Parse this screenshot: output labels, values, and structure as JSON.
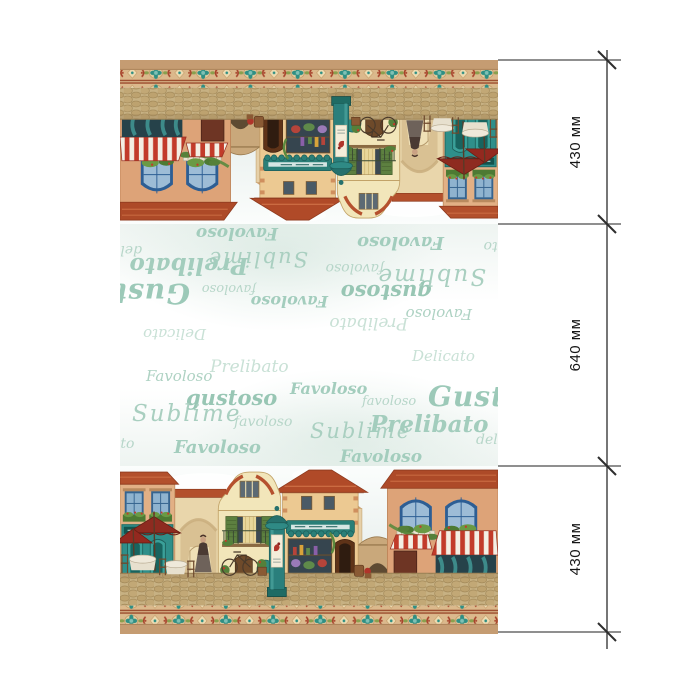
{
  "dimensions": {
    "segments": [
      {
        "label": "430 мм"
      },
      {
        "label": "640 мм"
      },
      {
        "label": "430 мм"
      }
    ]
  },
  "fabric": {
    "script_words": [
      {
        "text": "Favoloso"
      },
      {
        "text": "Prelibato"
      },
      {
        "text": "gustoso"
      },
      {
        "text": "Favoloso"
      },
      {
        "text": "favoloso"
      },
      {
        "text": "Gustoso"
      },
      {
        "text": "Sublime"
      },
      {
        "text": "favoloso"
      },
      {
        "text": "Sublime"
      },
      {
        "text": "Prelibato"
      },
      {
        "text": "delic"
      },
      {
        "text": "ato"
      },
      {
        "text": "Favoloso"
      },
      {
        "text": "Favoloso"
      },
      {
        "text": "Delicato"
      }
    ]
  },
  "colors": {
    "teal_accent": "#2f8f8a",
    "terracotta_roof": "#b04a28",
    "border_tan": "#c59c72",
    "script_mint": "#a3cdbd",
    "awning_red": "#c23b2a",
    "dimension_line": "#3c3c3c"
  }
}
